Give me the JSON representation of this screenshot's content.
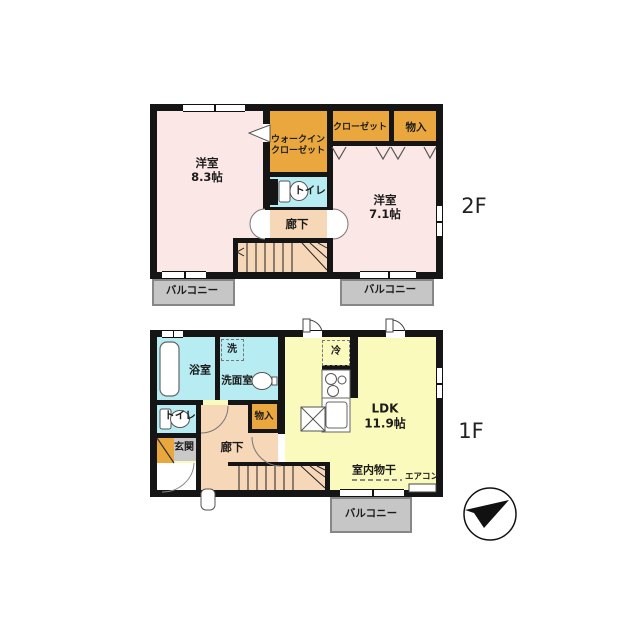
{
  "floor2": {
    "floor_label": "2F",
    "room_west": {
      "name": "洋室",
      "size": "8.3帖"
    },
    "wic": {
      "line1": "ウォークイン",
      "line2": "クローゼット"
    },
    "closet_label": "クローゼット",
    "storage_label": "物入",
    "toilet_label": "トイレ",
    "hallway_label": "廊下",
    "room_east": {
      "name": "洋室",
      "size": "7.1帖"
    },
    "balcony_left_label": "バルコニー",
    "balcony_right_label": "バルコニー"
  },
  "floor1": {
    "floor_label": "1F",
    "bathroom_label": "浴室",
    "washer_label": "洗",
    "washroom_label": "洗面室",
    "toilet_label": "トイレ",
    "entrance_label": "玄関",
    "hallway_label": "廊下",
    "storage_label": "物入",
    "ldk": {
      "name": "LDK",
      "size": "11.9帖"
    },
    "fridge_label": "冷",
    "indoor_drying_label": "室内物干",
    "aircon_label": "エアコン",
    "balcony_label": "バルコニー"
  },
  "colors": {
    "wall": "#151515",
    "room_pink": "#fbe7e5",
    "closet_orange": "#e9a73e",
    "wet_cyan": "#b7ecf3",
    "hall_peach": "#f6d7b8",
    "ldk_yellow": "#fafabc",
    "balcony_gray": "#c6c6c6",
    "entrance_gray": "#c9c9c9"
  }
}
